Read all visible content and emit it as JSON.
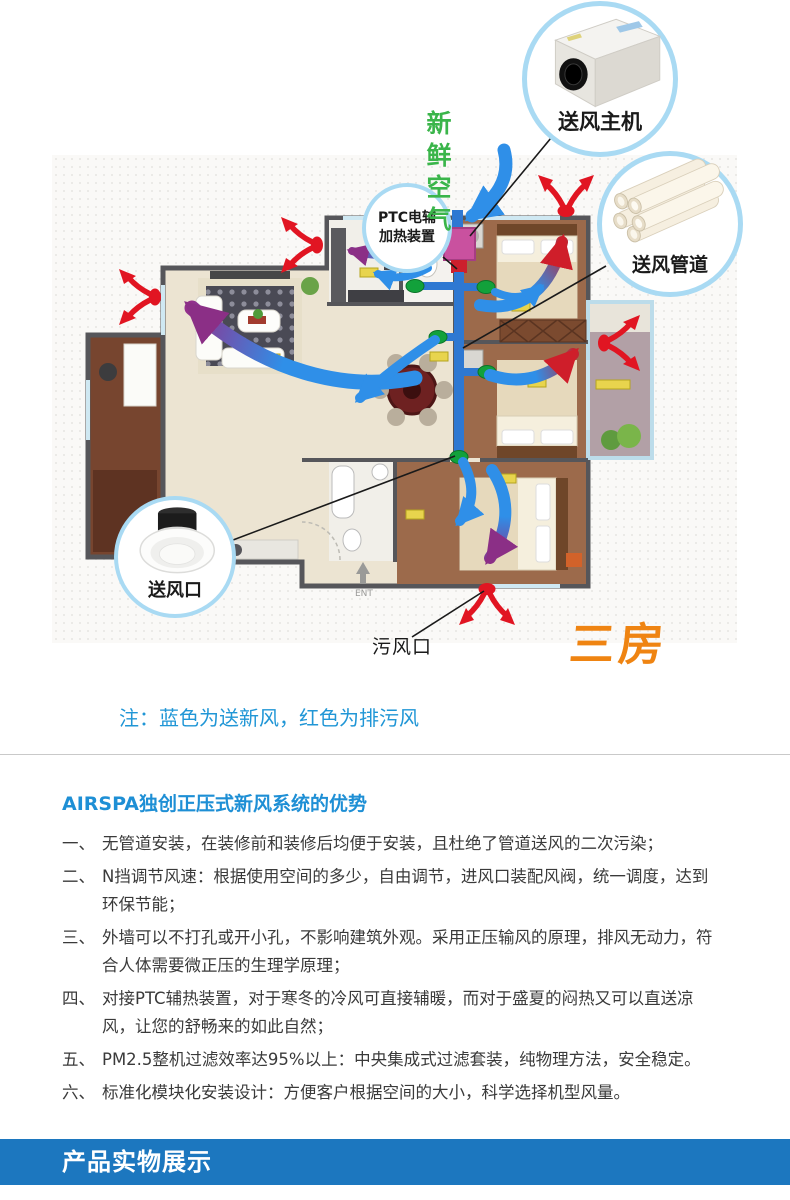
{
  "diagram": {
    "fresh_air_label": "新鲜空气",
    "callouts": {
      "main_unit": "送风主机",
      "duct": "送风管道",
      "outlet": "送风口",
      "dirty_outlet": "污风口",
      "ptc_line1": "PTC电辅",
      "ptc_line2": "加热装置"
    },
    "rooms_tag": "三房",
    "ent_label": "ENT",
    "note": "注：蓝色为送新风，红色为排污风",
    "colors": {
      "supply_blue": "#2f8fe8",
      "exhaust_red": "#e11522",
      "fresh_green": "#3ab54a",
      "ptc_pink": "#c9519f",
      "vent_green": "#12a13b",
      "rooms_orange": "#ef8412",
      "note_blue": "#2096d6"
    }
  },
  "advantages": {
    "title": "AIRSPA独创正压式新风系统的优势",
    "items": [
      {
        "num": "一、",
        "text": "无管道安装，在装修前和装修后均便于安装，且杜绝了管道送风的二次污染；"
      },
      {
        "num": "二、",
        "text": "N挡调节风速：根据使用空间的多少，自由调节，进风口装配风阀，统一调度，达到环保节能；"
      },
      {
        "num": "三、",
        "text": "外墙可以不打孔或开小孔，不影响建筑外观。采用正压输风的原理，排风无动力，符合人体需要微正压的生理学原理；"
      },
      {
        "num": "四、",
        "text": "对接PTC辅热装置，对于寒冬的冷风可直接辅暖，而对于盛夏的闷热又可以直送凉风，让您的舒畅来的如此自然；"
      },
      {
        "num": "五、",
        "text": "PM2.5整机过滤效率达95%以上：中央集成式过滤套装，纯物理方法，安全稳定。"
      },
      {
        "num": "六、",
        "text": "标准化模块化安装设计：方便客户根据空间的大小，科学选择机型风量。"
      }
    ]
  },
  "banner": {
    "title": "产品实物展示"
  }
}
